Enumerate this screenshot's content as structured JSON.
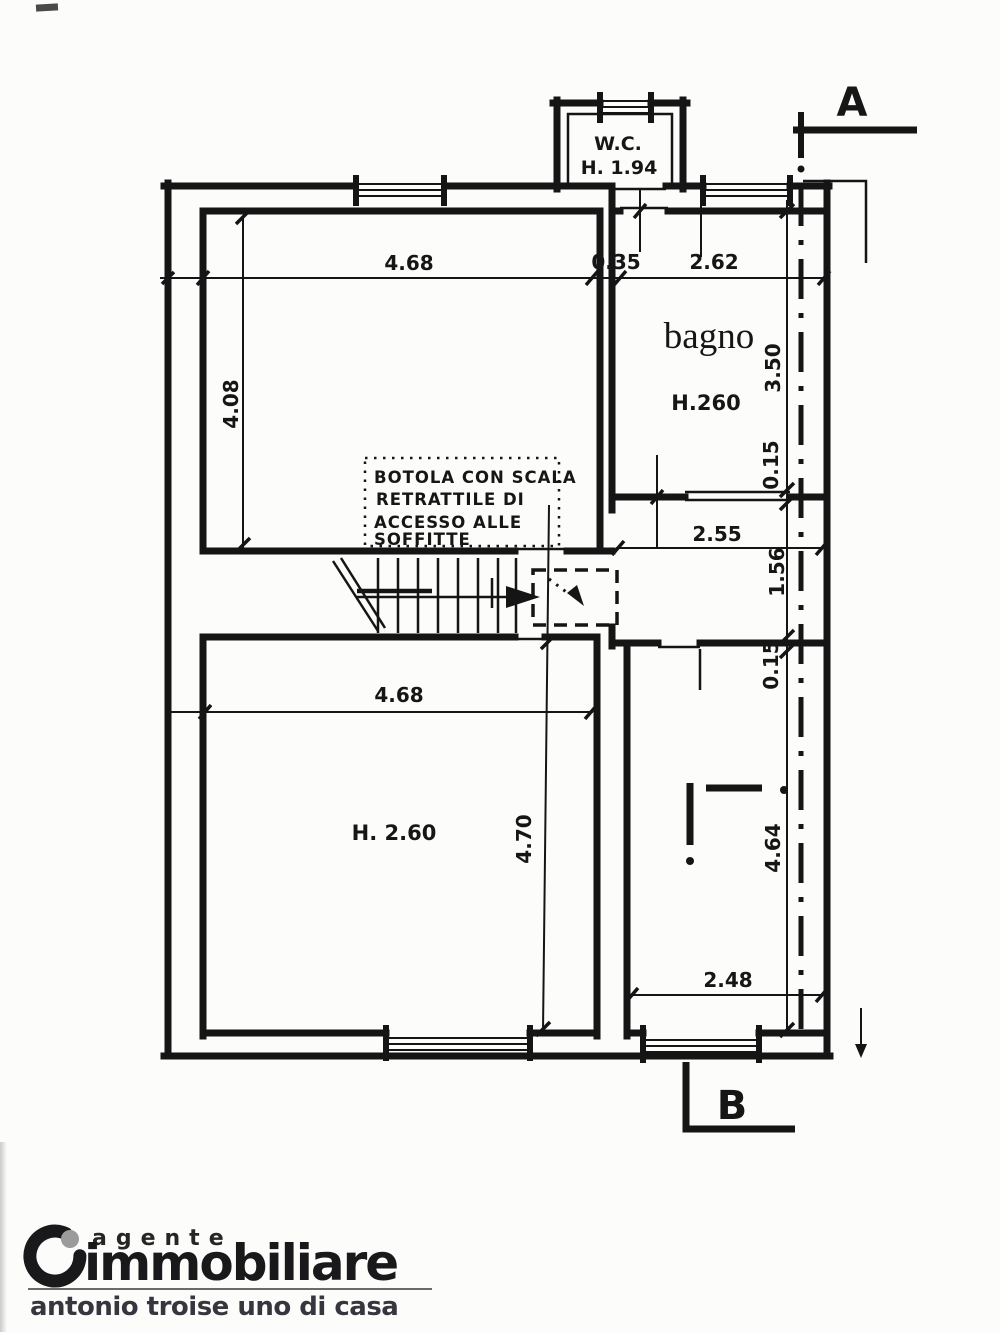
{
  "plan": {
    "section_markers": {
      "a": "A",
      "b": "B"
    },
    "rooms": {
      "wc": {
        "name": "W.C.",
        "height": "H. 1.94"
      },
      "bagno": {
        "name": "bagno",
        "height": "H.260"
      },
      "bottom_left": {
        "height": "H. 2.60"
      }
    },
    "attic_note": {
      "lines": [
        "BOTOLA CON SCALA",
        "RETRATTILE DI",
        "ACCESSO ALLE",
        "SOFFITTE"
      ]
    },
    "dimensions": {
      "top_room_width": "4.68",
      "wc_offset": "0.35",
      "bagno_width": "2.62",
      "top_room_height": "4.08",
      "bagno_height": "3.50",
      "bagno_wall": "0.15",
      "hall_width": "2.55",
      "hall_height": "1.56",
      "right_wall": "0.15",
      "bottom_room_width": "4.68",
      "bottom_room_height": "4.70",
      "right_room_height": "4.64",
      "right_room_width": "2.48"
    }
  },
  "footer": {
    "brand_top": "agente",
    "brand_main": "immobiliare",
    "tagline": "antonio troise uno di casa",
    "accent_gray": "#9b9b9b",
    "ink": "#19191b"
  }
}
